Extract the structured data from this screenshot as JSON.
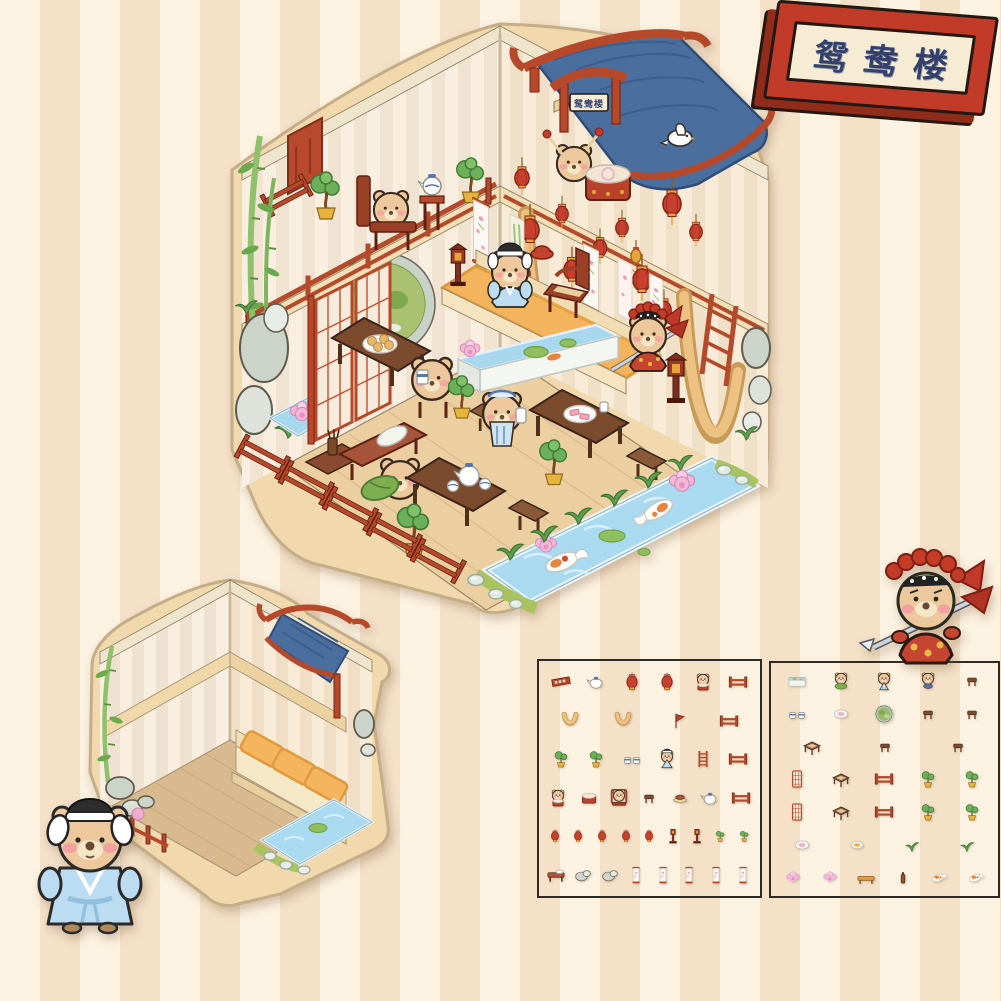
{
  "background": {
    "stripe_light": "#fcf2e1",
    "stripe_dark": "#f4e1c8",
    "stripe_width_px": 40
  },
  "sign": {
    "text": "鸳鸯楼",
    "frame_color": "#c23b28",
    "frame_side_color": "#922c1a",
    "plaque_color": "#f6ecd4",
    "text_color": "#32406e"
  },
  "main_scene": {
    "gate_plaque_text": "鸳鸯楼",
    "palette": {
      "sticker_border": "#f2d9ad",
      "roof_red": "#b6492a",
      "awning_blue": "#4a6f9f",
      "lantern_red": "#c8402e",
      "wood_floor": "#eccfa0",
      "pond_blue": "#a9daf0",
      "grass_green": "#a9c45e",
      "stage_orange": "#f4b45e",
      "furniture_red": "#a8422a",
      "bear_fur": "#ecc89c"
    },
    "elements": [
      "upper balcony with seated bear",
      "tea stand with teapot",
      "shelf with porcelain plates",
      "red wall tapestry",
      "bonsai pots",
      "red railings",
      "blue cloth awning roof",
      "white dove",
      "bear drummer with drum",
      "gate plaque",
      "hanging red lanterns",
      "tan curtain swags",
      "stage with scholar bear, armchair and opera bear",
      "wall scrolls",
      "ladder",
      "floor lamps",
      "moon gate",
      "open red lattice doors",
      "garden rocks",
      "small lotus pond",
      "bench with pillow and bear hugging cabbage",
      "dining tables with tea sets and dishes",
      "seated guest bears",
      "waiter bear",
      "fish tank with koi and lotus",
      "koi pond with two koi, lotus flowers and lily pads",
      "stone and grass border",
      "bamboo stalks"
    ]
  },
  "empty_room": {
    "elements": [
      "striped walls",
      "wall shelf",
      "blue awning roof",
      "stage platform with three orange mats",
      "wooden floor",
      "bamboo stalk",
      "garden rocks",
      "corner pond with stones",
      "small red fence with lotus"
    ]
  },
  "characters": [
    {
      "name": "scholar-bear",
      "outfit": "light blue robe, black scholar hat with white side wings"
    },
    {
      "name": "opera-bear",
      "outfit": "red opera costume, red pompom headdress, spear and back flags"
    }
  ],
  "sheet1": {
    "rows": [
      [
        "plaque",
        "teapot",
        "lantern",
        "lantern",
        "bear-drum",
        "fence"
      ],
      [
        "swag",
        "swag",
        "banner",
        "fence"
      ],
      [
        "bonsai",
        "bonsai",
        "cups",
        "bear-scholar",
        "ladder",
        "fence"
      ],
      [
        "bear-drum",
        "drum",
        "bear-chair",
        "stool",
        "meat",
        "teapot",
        "fence"
      ],
      [
        "lantern-s",
        "lantern-s",
        "lantern-s",
        "lantern-s",
        "lantern-s",
        "lamp",
        "lamp",
        "bonsai-s",
        "bonsai-s"
      ],
      [
        "bench",
        "rock",
        "rock",
        "scroll",
        "scroll",
        "scroll",
        "scroll",
        "scroll"
      ]
    ]
  },
  "sheet2": {
    "rows": [
      [
        "tank",
        "bear-veggie",
        "bear-apron",
        "bear-bowl",
        "stool"
      ],
      [
        "cups",
        "plate",
        "moongate",
        "stool",
        "stool"
      ],
      [
        "table",
        "stool",
        "stool"
      ],
      [
        "door",
        "table",
        "fence",
        "bonsai",
        "bonsai"
      ],
      [
        "door",
        "table",
        "fence",
        "bonsai",
        "bonsai"
      ],
      [
        "plate",
        "plate-y",
        "grass",
        "grass"
      ],
      [
        "lotus",
        "lotus",
        "bench-o",
        "bottle",
        "koi",
        "koi"
      ]
    ]
  }
}
